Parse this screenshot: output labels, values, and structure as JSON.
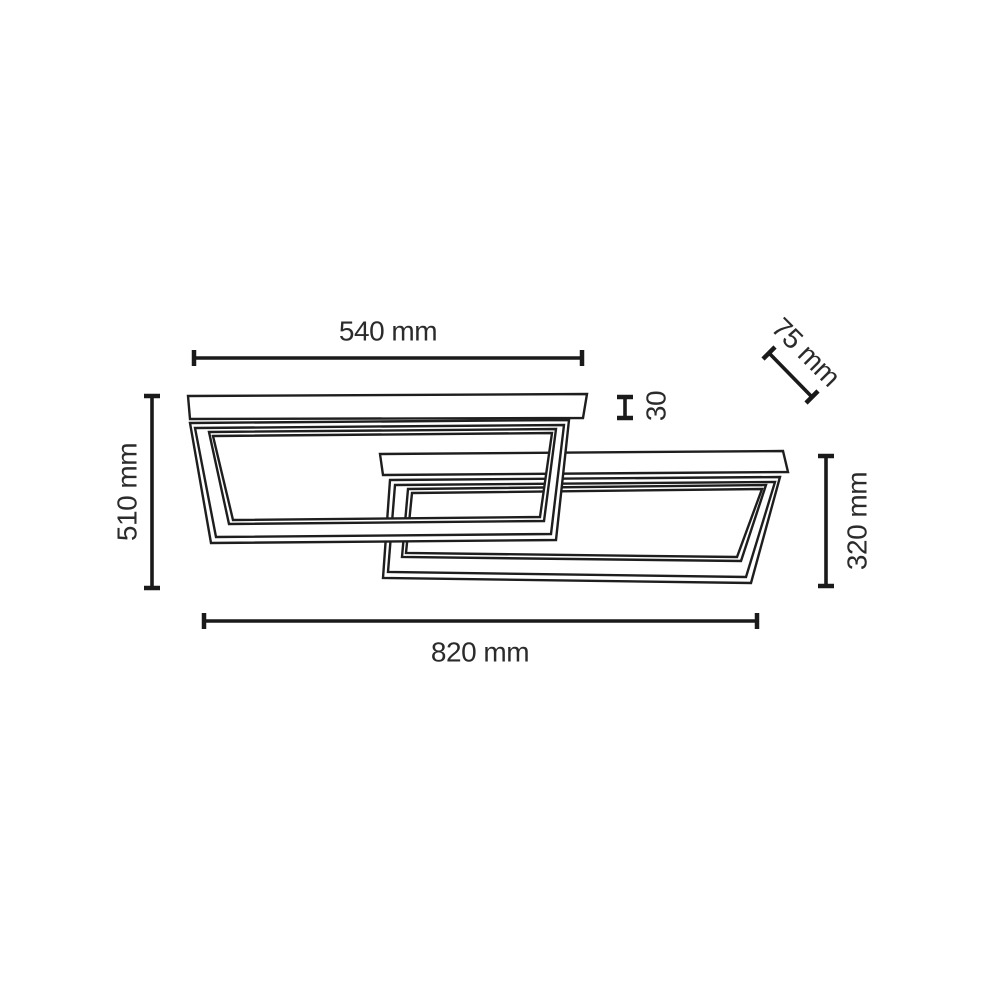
{
  "drawing": {
    "type": "technical-dimension-diagram",
    "subject": "ceiling light with two overlapping rectangular frames",
    "background": "#ffffff",
    "stroke_color": "#1e1e1e",
    "text_color": "#2b2b2b"
  },
  "dimensions": {
    "top_width": {
      "label": "540 mm",
      "value_mm": 540
    },
    "profile_depth": {
      "label": "75 mm",
      "value_mm": 75
    },
    "profile_height": {
      "label": "30",
      "value_mm": 30
    },
    "left_height": {
      "label": "510 mm",
      "value_mm": 510
    },
    "right_height": {
      "label": "320 mm",
      "value_mm": 320
    },
    "total_width": {
      "label": "820 mm",
      "value_mm": 820
    }
  }
}
